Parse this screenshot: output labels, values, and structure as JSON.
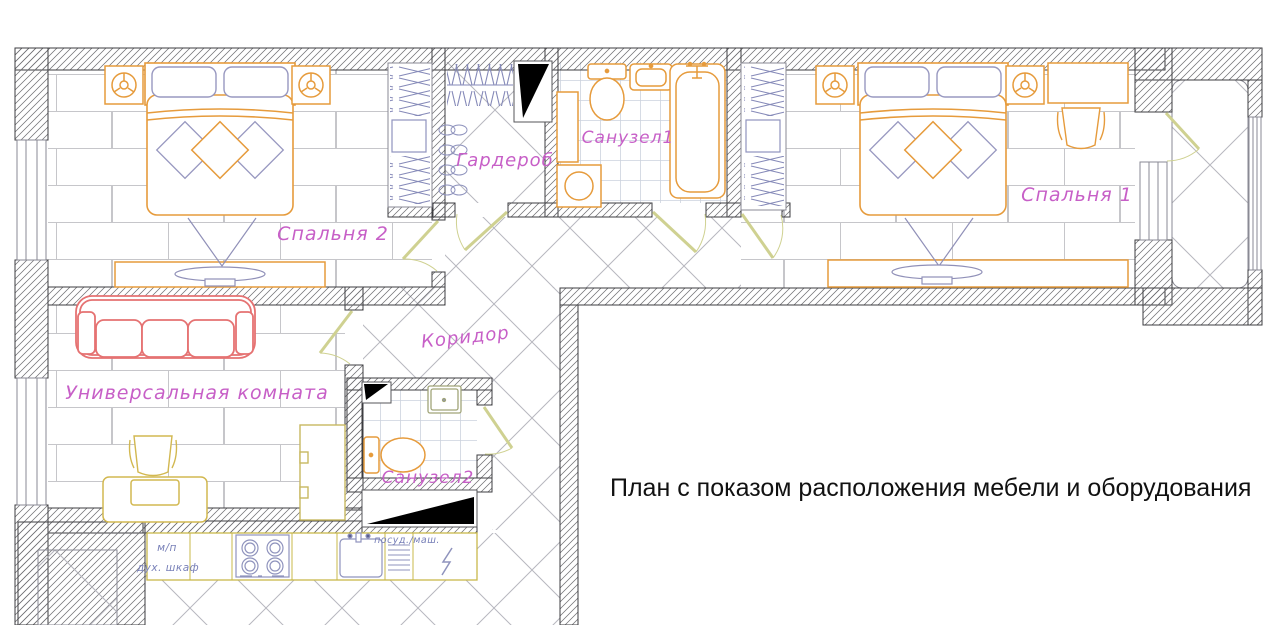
{
  "title": "План с показом расположения мебели и оборудования",
  "labels": {
    "bedroom2": "Спальня 2",
    "wardrobe": "Гардероб",
    "bathroom1": "Санузел1",
    "bedroom1": "Спальня 1",
    "corridor": "Коридор",
    "universal_room": "Универсальная комната",
    "bathroom2": "Санузел2"
  },
  "kitchen": {
    "microwave_abbr": "м/п",
    "oven_cabinet": "дух. шкаф",
    "dishwasher": "посуд./маш."
  },
  "colors": {
    "furniture_orange": "#e69b3c",
    "sofa_red": "#e57272",
    "desk_yellow": "#d2b850",
    "accent_blue": "#8f93bd",
    "label_magenta": "#c75fc7",
    "door_pale": "#cfd191",
    "title_black": "#111111"
  }
}
